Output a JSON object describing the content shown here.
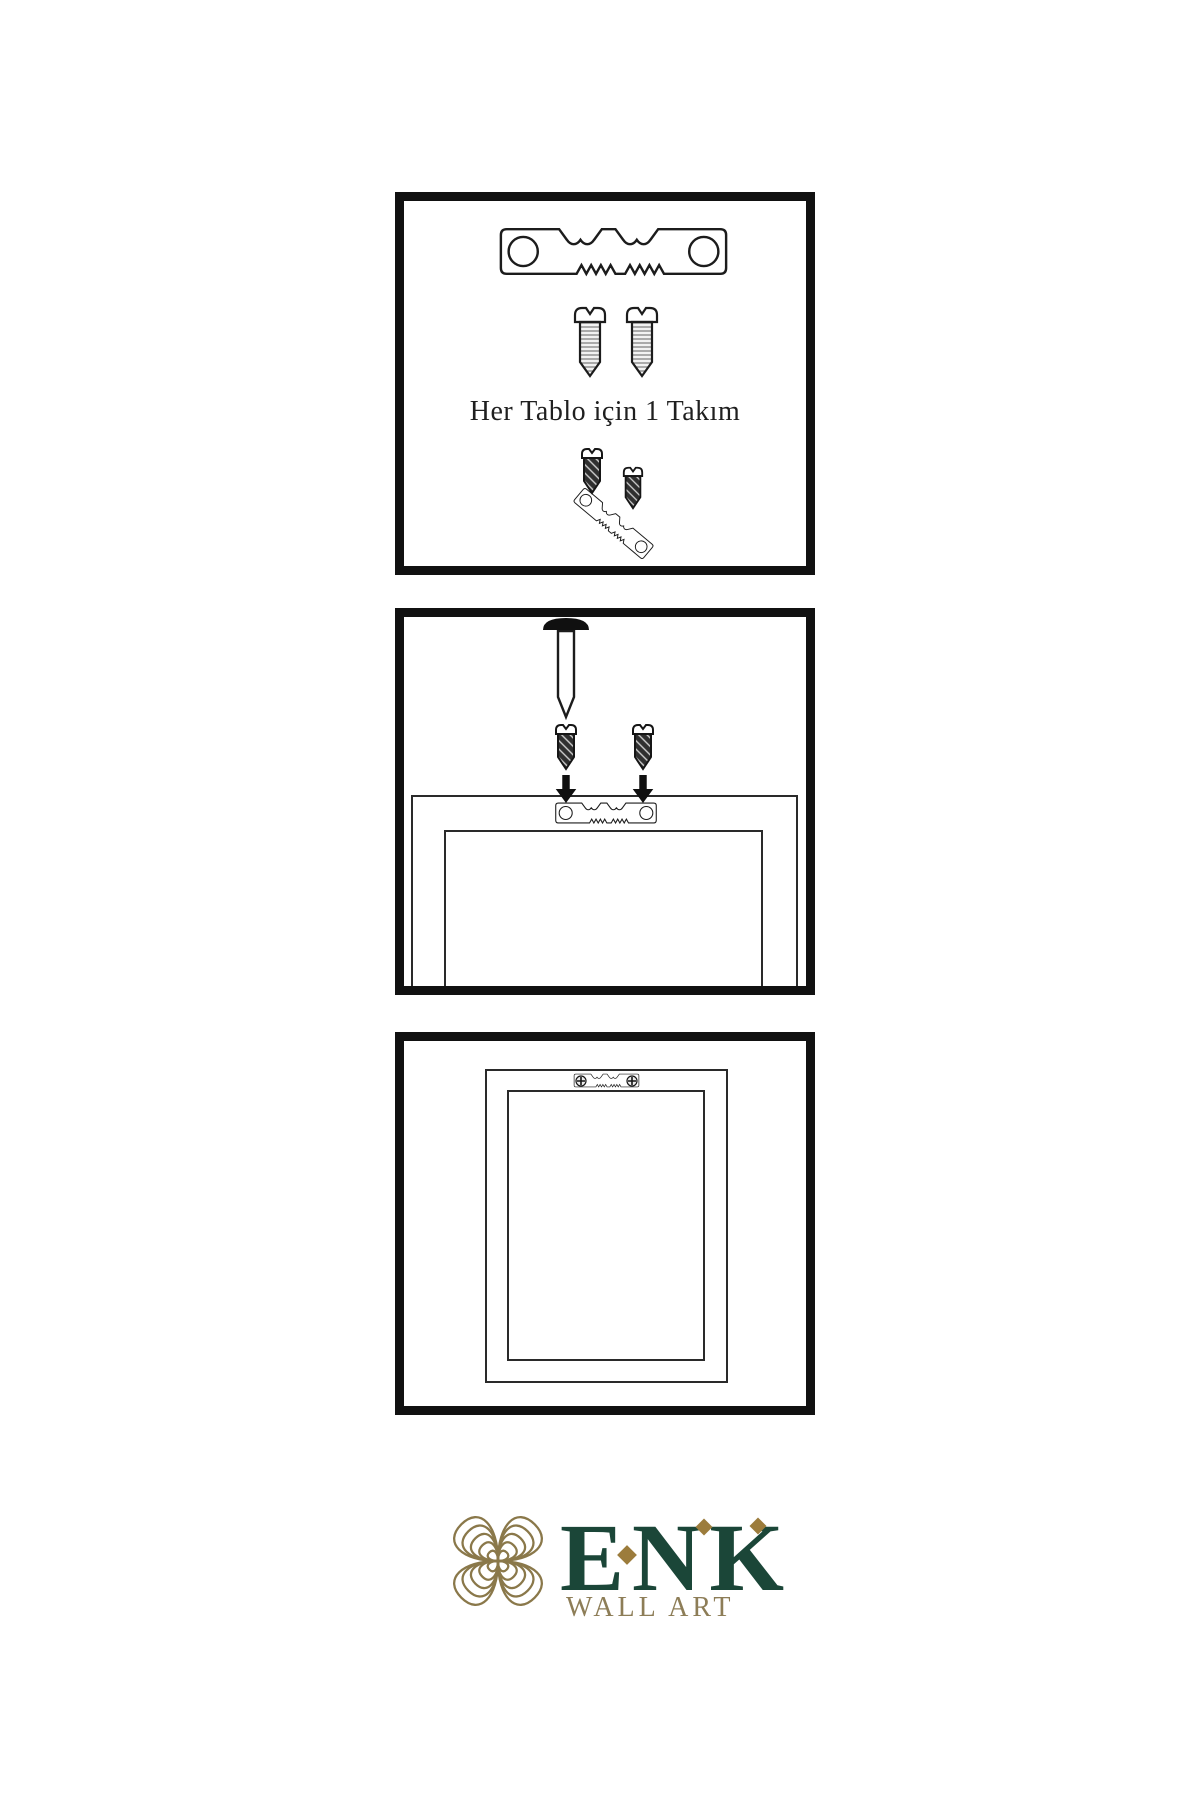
{
  "document": {
    "type": "wall-art-hanging-instructions",
    "background": "#ffffff"
  },
  "panels": [
    {
      "step": 1,
      "caption": "Her Tablo için 1 Takım",
      "icons": [
        "sawtooth-hanger-icon",
        "screw-icon",
        "screw-icon",
        "screw-icon",
        "tilted-sawtooth-hanger-icon",
        "screw-icon"
      ]
    },
    {
      "step": 2,
      "icons": [
        "nail-icon",
        "screw-icon",
        "screw-icon",
        "down-arrow-icon",
        "down-arrow-icon",
        "frame-back-outline",
        "sawtooth-hanger-icon"
      ]
    },
    {
      "step": 3,
      "icons": [
        "frame-back-outline",
        "sawtooth-hanger-mounted-icon",
        "phillips-screw-icon",
        "phillips-screw-icon"
      ]
    }
  ],
  "logo": {
    "brand": "ENK",
    "subtitle": "WALL ART",
    "knot_icon": "knot-icon",
    "colors": {
      "brand_green": "#1b4638",
      "knot_gold": "#8a784a",
      "subtitle_gold": "#8d7d57",
      "diamond_gold": "#9c7c3c"
    }
  },
  "colors": {
    "panel_border": "#111111",
    "drawing_line": "#2a2a2a",
    "ink": "#1f1f1f"
  }
}
